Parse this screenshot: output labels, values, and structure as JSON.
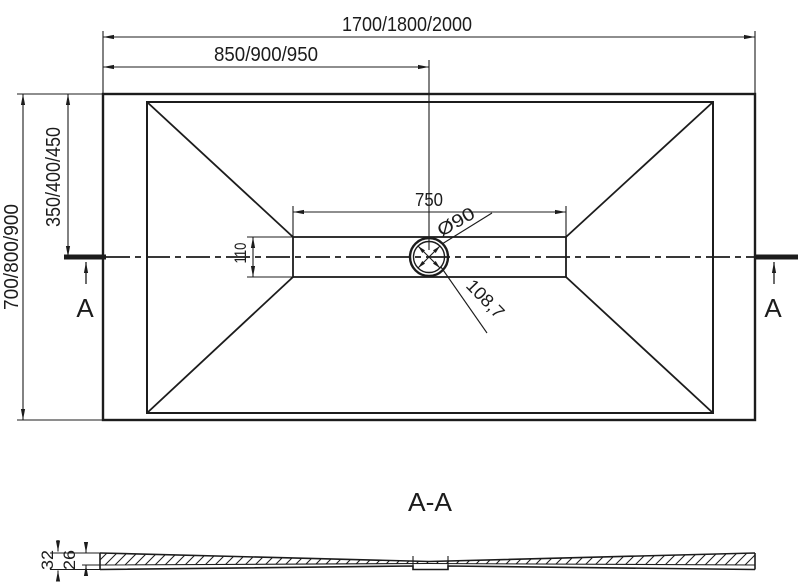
{
  "drawing": {
    "colors": {
      "line": "#1c1c1c",
      "background": "#ffffff"
    },
    "top_view": {
      "dim_overall_width": "1700/1800/2000",
      "dim_center_from_left": "850/900/950",
      "dim_overall_depth": "700/800/900",
      "dim_center_from_top": "350/400/450",
      "dim_channel_length": "750",
      "dim_channel_width": "110",
      "dim_drain_diameter": "Ø90",
      "dim_drain_diagonal": "108,7",
      "section_marker_left": "A",
      "section_marker_right": "A"
    },
    "section_view": {
      "title": "A-A",
      "dim_total_thickness": "32",
      "dim_edge_thickness": "26"
    }
  }
}
